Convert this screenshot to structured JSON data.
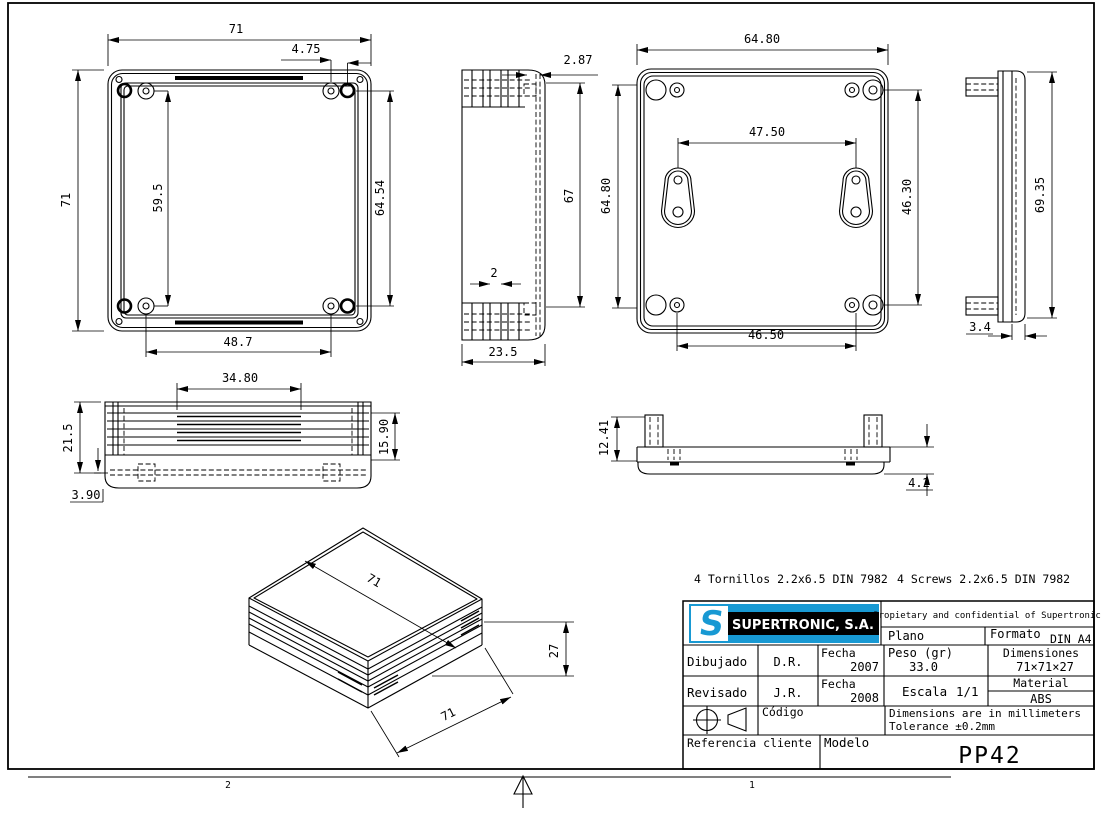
{
  "page": {
    "accent_blue": "#1899d3",
    "line_color": "#000000",
    "zone_left": "2",
    "zone_right": "1"
  },
  "notes": {
    "tornillos": "4 Tornillos 2.2x6.5 DIN 7982",
    "screws": "4 Screws 2.2x6.5 DIN 7982"
  },
  "views": {
    "top": {
      "w": "71",
      "offset": "4.75",
      "h": "71",
      "span_v": "59.5",
      "span_v2": "64.54",
      "span_h": "48.7"
    },
    "side": {
      "lip": "2.87",
      "inner_h": "67",
      "gap": "2",
      "depth": "23.5"
    },
    "bottom": {
      "w": "64.80",
      "h": "64.80",
      "keyholes": "47.50",
      "span_r": "46.30",
      "span_b": "46.50"
    },
    "lid_side": {
      "h": "69.35",
      "t": "3.4"
    },
    "front": {
      "vent_w": "34.80",
      "h": "21.5",
      "rib_h": "15.90",
      "skirt": "3.90"
    },
    "lid_front": {
      "post_h": "12.41",
      "flange": "4.2"
    },
    "iso": {
      "w": "71",
      "h": "27",
      "d": "71"
    }
  },
  "title_block": {
    "logo_s": "S",
    "logo_text": "SUPERTRONIC, S.A.",
    "confidential": "Propietary and confidential of Supertronic",
    "plano_label": "Plano",
    "formato_label": "Formato",
    "formato_value": "DIN A4",
    "dibujado_label": "Dibujado",
    "dibujado_value": "D.R.",
    "fecha1_label": "Fecha",
    "fecha1_value": "2007",
    "peso_label": "Peso (gr)",
    "peso_value": "33.0",
    "dimensiones_label": "Dimensiones",
    "dimensiones_value": "71×71×27",
    "revisado_label": "Revisado",
    "revisado_value": "J.R.",
    "fecha2_label": "Fecha",
    "fecha2_value": "2008",
    "escala_label": "Escala",
    "escala_value": "1/1",
    "material_label": "Material",
    "material_value": "ABS",
    "codigo_label": "Código",
    "dim_note_1": "Dimensions are in millimeters",
    "dim_note_2": "Tolerance ±0.2mm",
    "referencia_label": "Referencia cliente",
    "modelo_label": "Modelo",
    "modelo_value": "PP42"
  }
}
